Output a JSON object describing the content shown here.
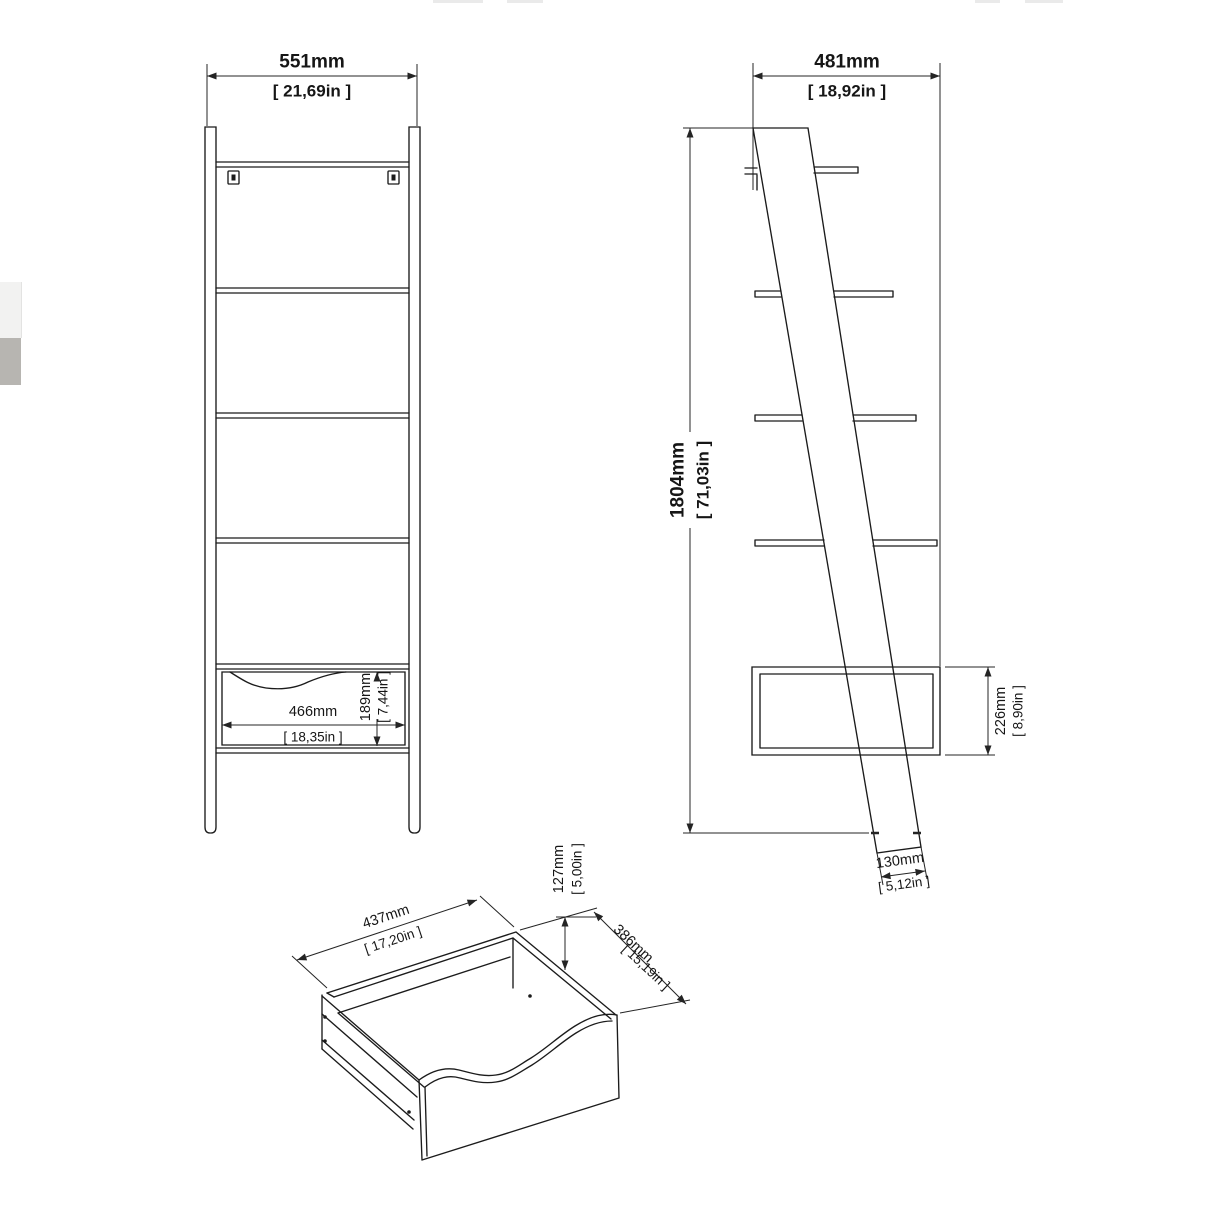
{
  "front_view": {
    "width_mm": "551mm",
    "width_in": "[ 21,69in ]",
    "drawer_width_mm": "466mm",
    "drawer_width_in": "[ 18,35in ]",
    "drawer_height_mm": "189mm",
    "drawer_height_in": "[ 7,44in ]"
  },
  "side_view": {
    "depth_mm": "481mm",
    "depth_in": "[ 18,92in ]",
    "height_mm": "1804mm",
    "height_in": "[ 71,03in ]",
    "drawer_section_mm": "226mm",
    "drawer_section_in": "[ 8,90in ]",
    "panel_width_mm": "130mm",
    "panel_width_in": "[ 5,12in ]"
  },
  "drawer_detail": {
    "width_mm": "437mm",
    "width_in": "[ 17,20in ]",
    "height_mm": "127mm",
    "height_in": "[ 5,00in ]",
    "depth_mm": "386mm",
    "depth_in": "[ 15,19in ]"
  }
}
